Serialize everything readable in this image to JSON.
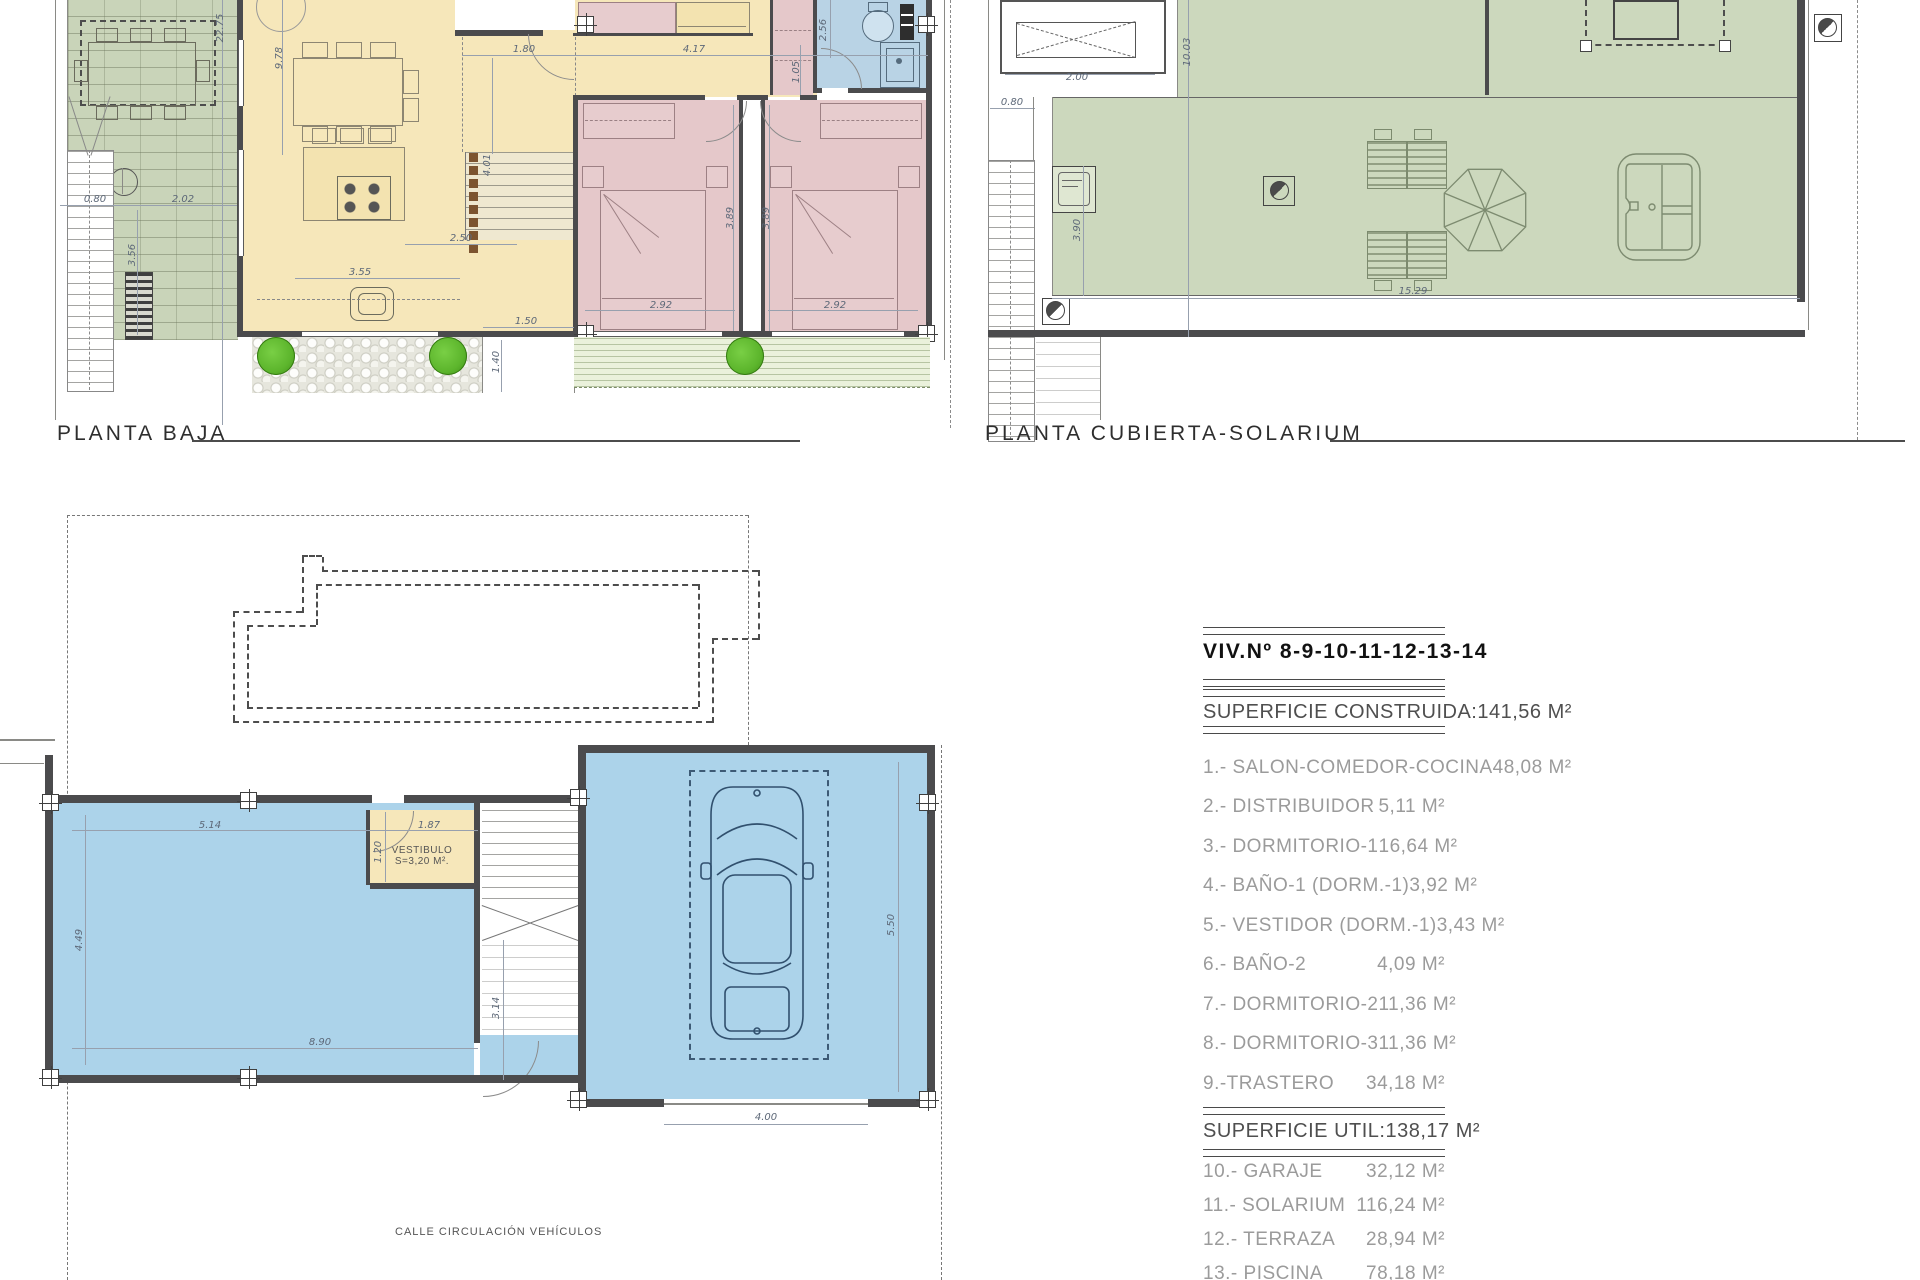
{
  "sheet": {
    "plan_labels": {
      "planta_baja": "PLANTA BAJA",
      "planta_cubierta": "PLANTA CUBIERTA-SOLARIUM"
    },
    "vestibulo": {
      "name": "VESTIBULO",
      "area": "S=3,20 M²."
    },
    "street_label": "CALLE CIRCULACIÓN VEHÍCULOS"
  },
  "dimensions": [
    {
      "t": "22.75",
      "x": 221,
      "y": 28,
      "r": 1
    },
    {
      "t": "9.78",
      "x": 280,
      "y": 58,
      "r": 1
    },
    {
      "t": "1.80",
      "x": 524,
      "y": 50
    },
    {
      "t": "4.17",
      "x": 694,
      "y": 50
    },
    {
      "t": "2.56",
      "x": 824,
      "y": 30,
      "r": 1
    },
    {
      "t": "1.05",
      "x": 797,
      "y": 72,
      "r": 1
    },
    {
      "t": "0.80",
      "x": 95,
      "y": 200
    },
    {
      "t": "2.02",
      "x": 183,
      "y": 200
    },
    {
      "t": "3.56",
      "x": 133,
      "y": 255,
      "r": 1
    },
    {
      "t": "4.01",
      "x": 488,
      "y": 165,
      "r": 1
    },
    {
      "t": "2.50",
      "x": 461,
      "y": 239
    },
    {
      "t": "3.55",
      "x": 360,
      "y": 273
    },
    {
      "t": "3.89",
      "x": 731,
      "y": 218,
      "r": 1
    },
    {
      "t": "3.89",
      "x": 767,
      "y": 218,
      "r": 1
    },
    {
      "t": "2.92",
      "x": 661,
      "y": 306
    },
    {
      "t": "2.92",
      "x": 835,
      "y": 306
    },
    {
      "t": "1.50",
      "x": 526,
      "y": 322
    },
    {
      "t": "1.40",
      "x": 497,
      "y": 362,
      "r": 1
    },
    {
      "t": "2.00",
      "x": 1077,
      "y": 78
    },
    {
      "t": "0.80",
      "x": 1012,
      "y": 103
    },
    {
      "t": "10.03",
      "x": 1188,
      "y": 52,
      "r": 1
    },
    {
      "t": "3.90",
      "x": 1078,
      "y": 230,
      "r": 1
    },
    {
      "t": "15.29",
      "x": 1413,
      "y": 292
    },
    {
      "t": "5.14",
      "x": 210,
      "y": 826
    },
    {
      "t": "1.87",
      "x": 429,
      "y": 826
    },
    {
      "t": "1.20",
      "x": 379,
      "y": 852,
      "r": 1
    },
    {
      "t": "4.49",
      "x": 80,
      "y": 940,
      "r": 1
    },
    {
      "t": "8.90",
      "x": 320,
      "y": 1043
    },
    {
      "t": "3.14",
      "x": 497,
      "y": 1008,
      "r": 1
    },
    {
      "t": "5.50",
      "x": 892,
      "y": 925,
      "r": 1
    },
    {
      "t": "4.00",
      "x": 766,
      "y": 1118
    }
  ],
  "area_table": {
    "title_left": "VIV.",
    "title_right": "Nº 8-9-10-11-12-13-14",
    "sections": [
      {
        "header": "SUPERFICIE CONSTRUIDA:",
        "value": "141,56 M²",
        "rows": [
          {
            "label": "1.- SALON-COMEDOR-COCINA",
            "value": "48,08 M²"
          },
          {
            "label": "2.- DISTRIBUIDOR",
            "value": "5,11 M²"
          },
          {
            "label": "3.- DORMITORIO-1",
            "value": "16,64 M²"
          },
          {
            "label": "4.- BAÑO-1 (DORM.-1)",
            "value": "3,92 M²"
          },
          {
            "label": "5.- VESTIDOR (DORM.-1)",
            "value": "3,43 M²"
          },
          {
            "label": "6.- BAÑO-2",
            "value": "4,09 M²"
          },
          {
            "label": "7.- DORMITORIO-2",
            "value": "11,36 M²"
          },
          {
            "label": "8.- DORMITORIO-3",
            "value": "11,36 M²"
          },
          {
            "label": "9.-TRASTERO",
            "value": "34,18 M²"
          }
        ]
      },
      {
        "header": "SUPERFICIE UTIL:",
        "value": "138,17 M²",
        "rows": [
          {
            "label": "10.- GARAJE",
            "value": "32,12 M²"
          },
          {
            "label": "11.- SOLARIUM",
            "value": "116,24 M²"
          },
          {
            "label": "12.- TERRAZA",
            "value": "28,94 M²"
          },
          {
            "label": "13.- PISCINA",
            "value": "78,18 M²"
          }
        ]
      }
    ]
  },
  "colors": {
    "floor": "#F6E7BA",
    "bedroom": "#E5C8CA",
    "bath": "#B9D3E5",
    "garden": "#C9D4B9",
    "solarium": "#CCD8BD",
    "terrace": "#EAF1DB",
    "pool": "#ACD3EA",
    "bush": "#5CB52C",
    "wall": "#4B4B4D",
    "dim_text": "#5D6878"
  }
}
